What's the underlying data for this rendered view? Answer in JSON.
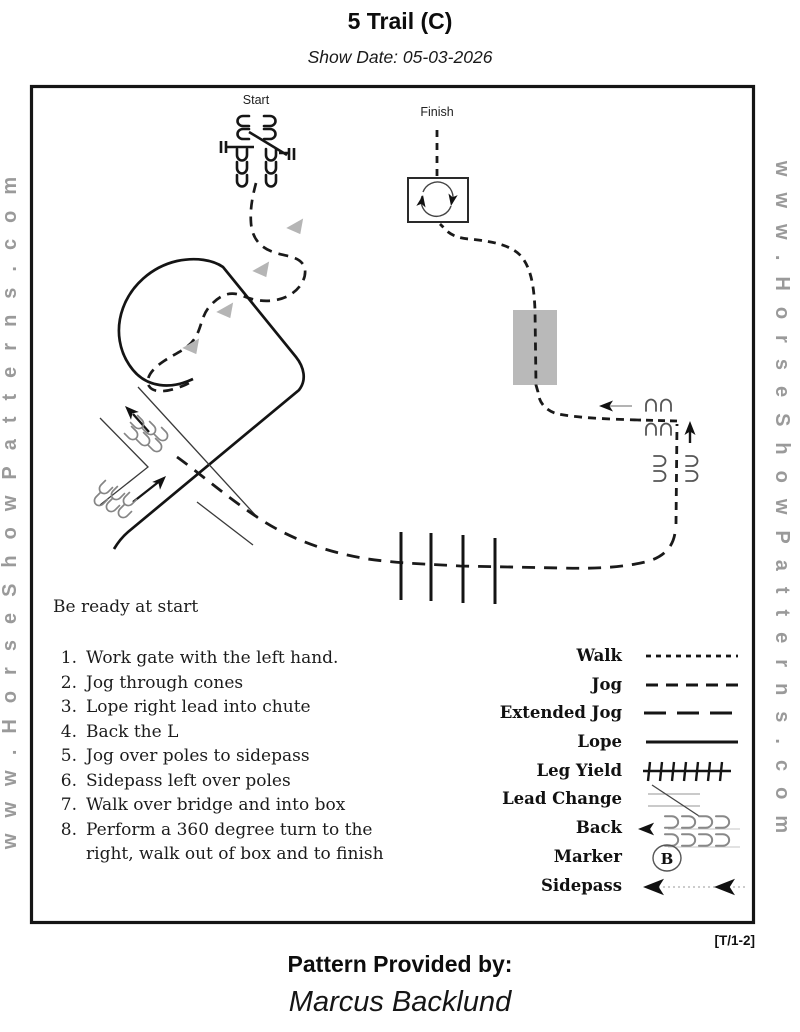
{
  "header": {
    "title": "5 Trail (C)",
    "show_date": "Show Date: 05-03-2026"
  },
  "watermark": {
    "text": "www.HorseShowPatterns.com"
  },
  "course": {
    "start_label": "Start",
    "finish_label": "Finish",
    "obstacles": [
      "gate",
      "cones",
      "chute",
      "back-L",
      "poles",
      "sidepass",
      "bridge",
      "turn-box"
    ]
  },
  "instructions": {
    "intro": "Be ready at start",
    "steps": [
      {
        "num": "1.",
        "text": "Work gate with the left hand."
      },
      {
        "num": "2.",
        "text": "Jog through cones"
      },
      {
        "num": "3.",
        "text": "Lope right lead into chute"
      },
      {
        "num": "4.",
        "text": "Back the L"
      },
      {
        "num": "5.",
        "text": "Jog over poles to sidepass"
      },
      {
        "num": "6.",
        "text": "Sidepass left over poles"
      },
      {
        "num": "7.",
        "text": "Walk over bridge and into box"
      },
      {
        "num": "8.",
        "text": "Perform a 360 degree turn to the right, walk out of box and to finish"
      }
    ]
  },
  "legend": {
    "items": [
      {
        "label": "Walk"
      },
      {
        "label": "Jog"
      },
      {
        "label": "Extended Jog"
      },
      {
        "label": "Lope"
      },
      {
        "label": "Leg Yield"
      },
      {
        "label": "Lead Change"
      },
      {
        "label": "Back"
      },
      {
        "label": "Marker",
        "letter": "B"
      },
      {
        "label": "Sidepass"
      }
    ]
  },
  "footer": {
    "sheet_code": "[T/1-2]",
    "provided_by": "Pattern Provided by:",
    "provider": "Marcus Backlund"
  },
  "colors": {
    "line": "#1a1a1a",
    "cone": "#b5b5b5",
    "bridge": "#b9b9b9",
    "watermark": "#9a9a9a"
  }
}
